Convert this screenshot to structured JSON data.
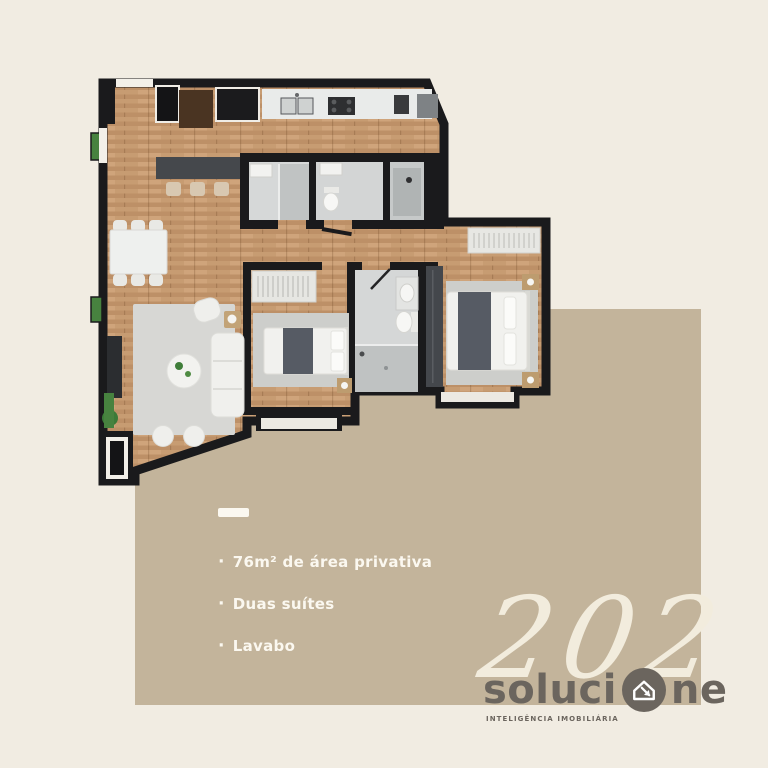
{
  "theme": {
    "background": "#f1ece2",
    "panel": "#c3b49b",
    "wall": "#1a1a1c",
    "wood": "#c79c72",
    "text_light": "#fbf8f0",
    "unit_cream": "#f2ecdd",
    "brand_gray": "#6b655e"
  },
  "features": {
    "bullet": "·",
    "items": [
      "76m² de área privativa",
      "Duas suítes",
      "Lavabo"
    ]
  },
  "unit": {
    "number": "202"
  },
  "brand": {
    "wordmark_left": "soluci",
    "wordmark_right": "ne",
    "icon": "house-arrow-icon",
    "tagline": "INTELIGÊNCIA IMOBILIÁRIA"
  }
}
